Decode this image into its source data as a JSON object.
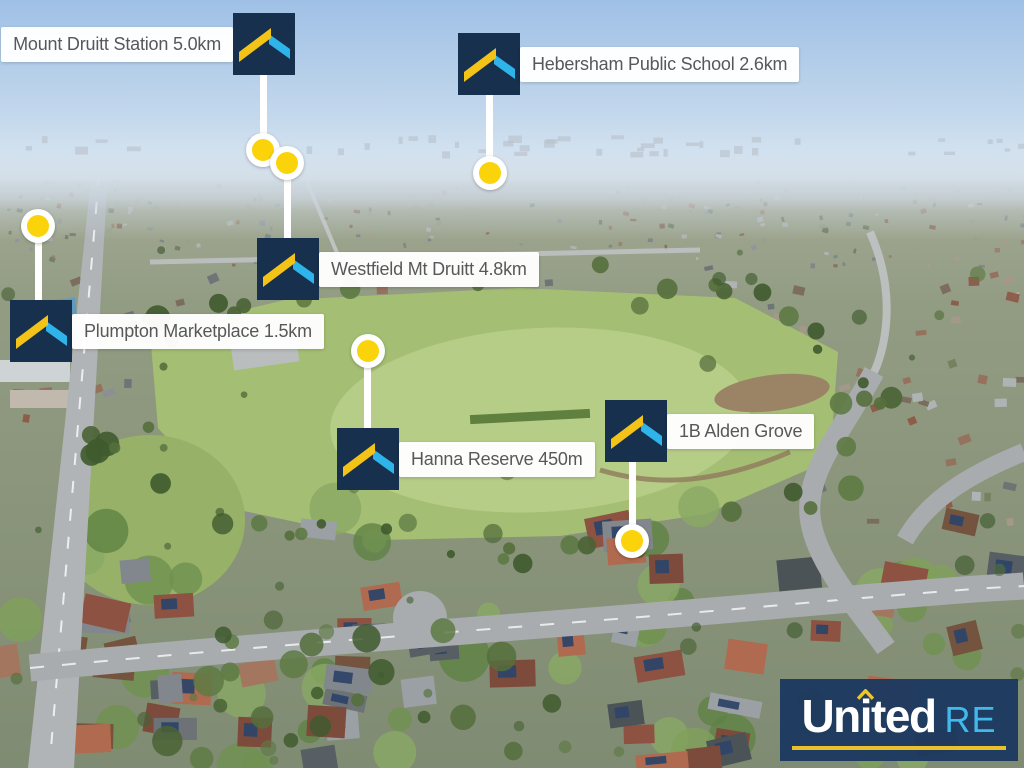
{
  "scene": {
    "alt": "Aerial drone photo of a suburb with a large green reserve, roads and houses; real-estate location markers overlaid"
  },
  "markers": [
    {
      "id": "mount-druitt-station",
      "label": "Mount Druitt Station 5.0km"
    },
    {
      "id": "hebersham-public-school",
      "label": "Hebersham Public School 2.6km"
    },
    {
      "id": "westfield-mt-druitt",
      "label": "Westfield Mt Druitt 4.8km"
    },
    {
      "id": "plumpton-marketplace",
      "label": "Plumpton Marketplace 1.5km"
    },
    {
      "id": "hanna-reserve",
      "label": "Hanna Reserve 450m"
    },
    {
      "id": "alden-grove",
      "label": "1B Alden Grove"
    }
  ],
  "watermark": {
    "name": "United",
    "suffix": "RE"
  },
  "icons": {
    "marker_logo": "roof-chevron-logo",
    "pin": "yellow-location-dot",
    "watermark_caret": "roof-caret"
  },
  "colors": {
    "brand_navy": "#16304e",
    "brand_yellow": "#f3c317",
    "brand_cyan": "#2fb4e9",
    "pin_yellow": "#fbd30a",
    "label_text": "#57585a",
    "label_bg": "#ffffff",
    "watermark_underline": "#eac02c"
  }
}
